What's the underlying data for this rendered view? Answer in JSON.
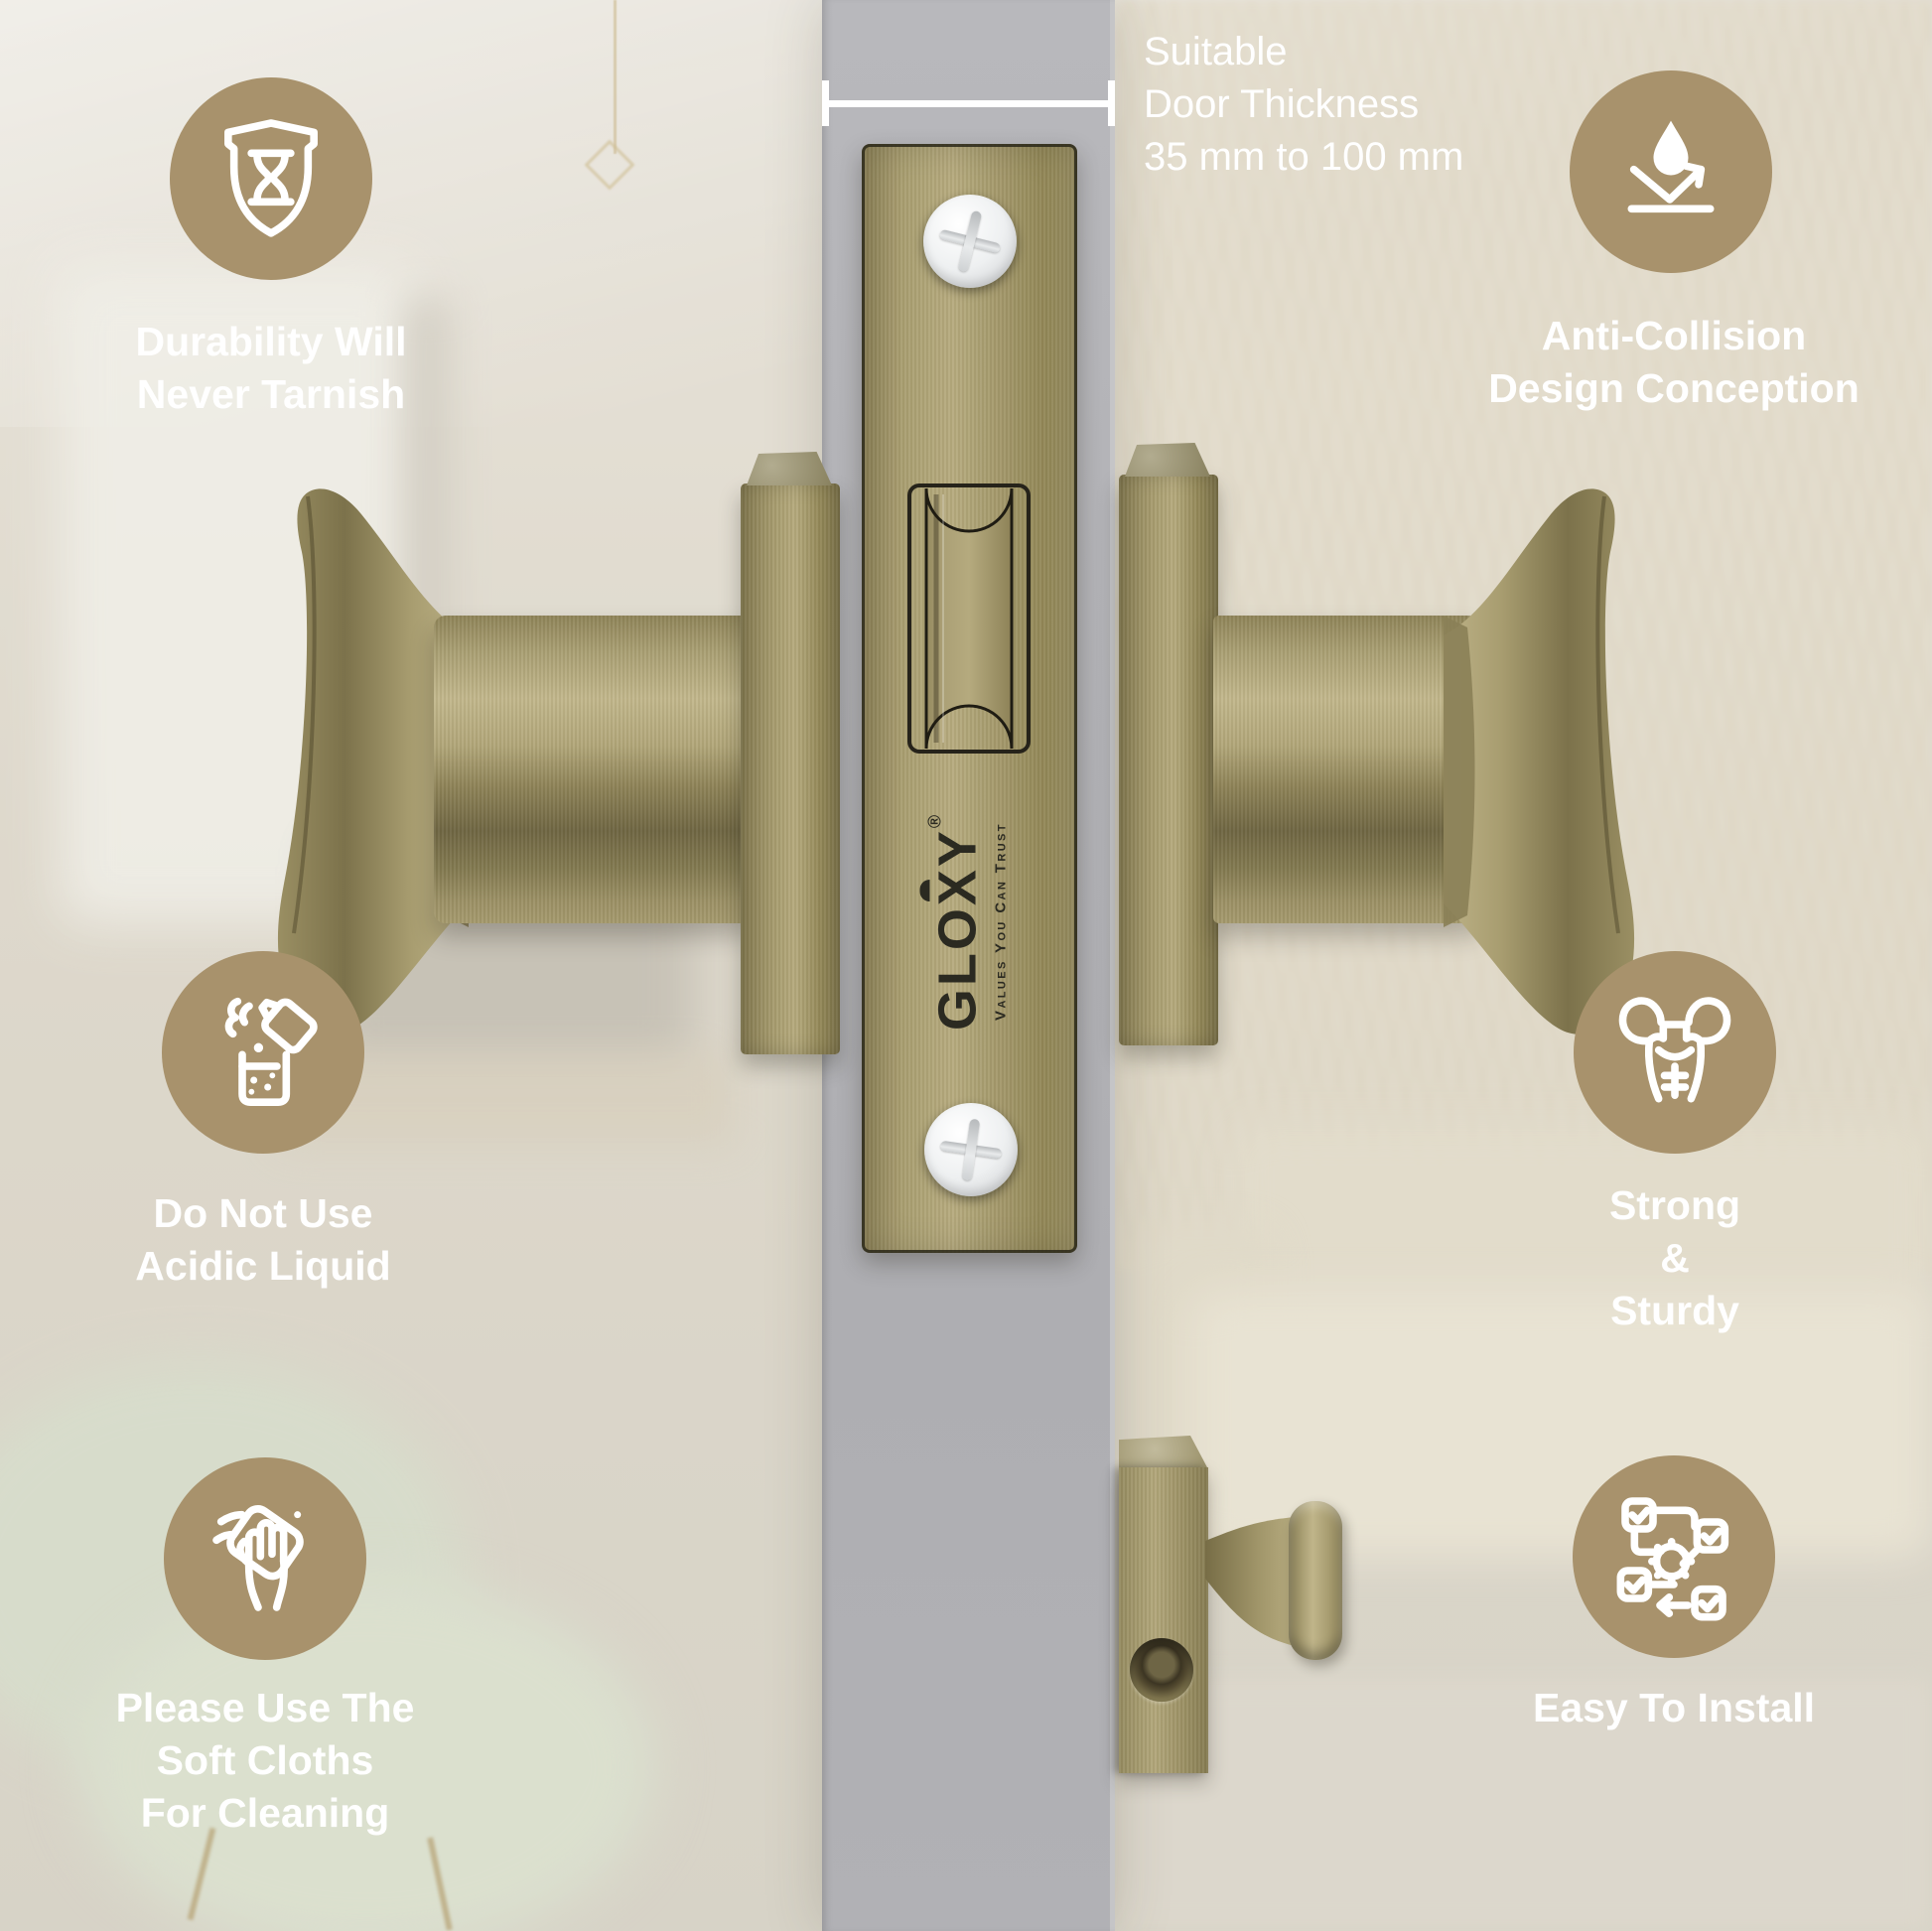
{
  "measurement": {
    "lines": [
      "Suitable",
      "Door Thickness",
      "35 mm to 100 mm"
    ]
  },
  "features": {
    "durability": {
      "icon": "shield-hourglass-icon",
      "lines": [
        "Durability Will",
        "Never Tarnish"
      ]
    },
    "anti_collision": {
      "icon": "drop-bounce-icon",
      "lines": [
        "Anti-Collision",
        "Design Conception"
      ]
    },
    "no_acid": {
      "icon": "acid-beaker-icon",
      "lines": [
        "Do Not Use",
        "Acidic Liquid"
      ]
    },
    "strong": {
      "icon": "muscle-man-icon",
      "lines": [
        "Strong",
        "&",
        "Sturdy"
      ]
    },
    "soft_cloth": {
      "icon": "hand-cloth-icon",
      "lines": [
        "Please Use The",
        "Soft Cloths",
        "For Cleaning"
      ]
    },
    "easy_install": {
      "icon": "install-flow-icon",
      "lines": [
        "Easy To Install"
      ]
    }
  },
  "brand": {
    "name": "GLOXY",
    "registered_mark": "®",
    "tagline": "Values You Can Trust"
  },
  "colors": {
    "accent_circle": "#a8926c",
    "door_gray": "#b1b1b5",
    "brass": "#a89d6f",
    "logo_text": "#2b2a21",
    "caption_text": "#ffffff"
  }
}
